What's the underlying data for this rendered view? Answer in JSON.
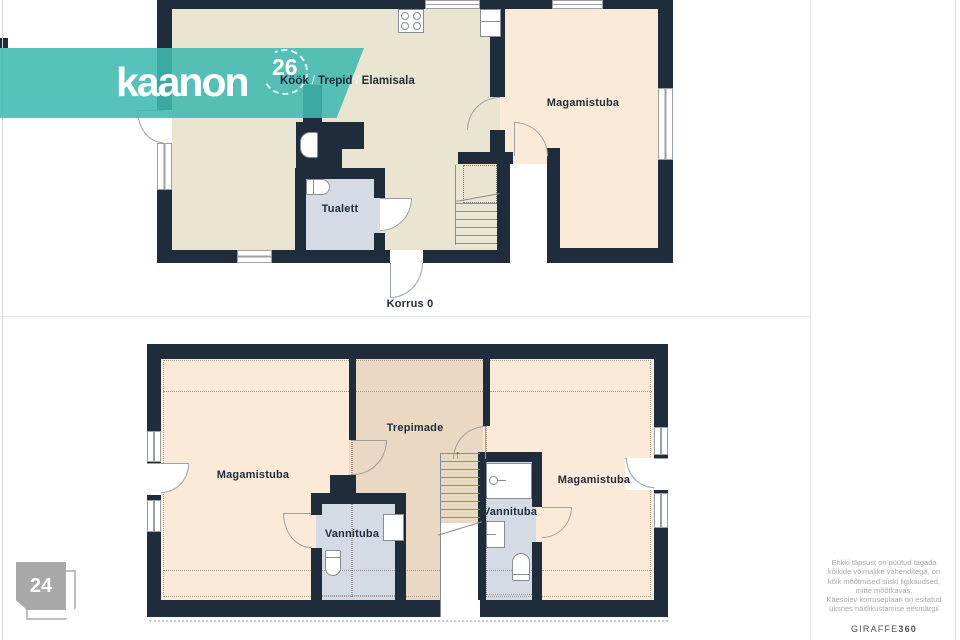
{
  "branding": {
    "logo_text": "kaanon",
    "unit_number": "26",
    "location_line": {
      "part1": "Köök",
      "part2": "Trepid",
      "part3": "Elamisala",
      "separator": "/"
    }
  },
  "floor0": {
    "caption": "Korrus 0",
    "labels": {
      "bedroom": "Magamistuba",
      "toilet": "Tualett"
    }
  },
  "floor1": {
    "labels": {
      "bedroom_left": "Magamistuba",
      "landing": "Trepimade",
      "bathroom_left": "Vannituba",
      "bathroom_right": "Vannituba",
      "bedroom_right": "Magamistuba"
    }
  },
  "icons": {
    "stairs_up_arrow": "↑"
  },
  "page_badge": {
    "number": "24"
  },
  "sidebar": {
    "disclaimer": {
      "line1": "Ehkki täpsust on püütud tagada",
      "line2": "kõikide võimalike vahenditega, on",
      "line3": "kõik mõõtmised siiski ligikaudsed,",
      "line4": "mitte mõõtkavas.",
      "line5": "Käesolev korruseplaan on esitatud",
      "line6": "üksnes näitlikustamise eesmärgil"
    },
    "watermark": {
      "brand": "GIRAFFE",
      "suffix": "360"
    }
  },
  "colors": {
    "wall": "#1e2c3c",
    "floor_living": "#eae5d1",
    "floor_bedroom": "#fcead9",
    "floor_landing": "#ebd8c2",
    "floor_bathroom": "#d5dbe4",
    "banner_teal": "#40b9b1",
    "text_navy": "#1e2c3c"
  }
}
